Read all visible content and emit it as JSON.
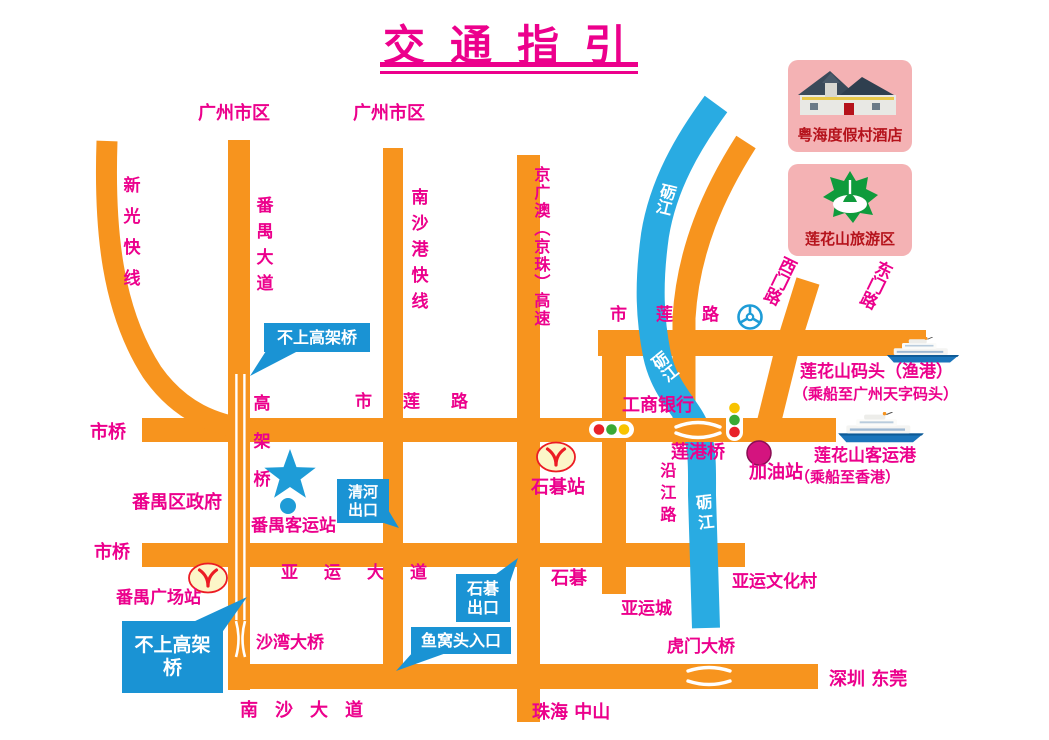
{
  "title": "交通指引",
  "panels": {
    "hotel": {
      "label": "粤海度假村酒店",
      "icon": "resort-hotel-photo"
    },
    "scenic": {
      "label": "莲花山旅游区",
      "icon": "lotus-mountain-emblem"
    }
  },
  "labels": {
    "gz_city_1": "广州市区",
    "gz_city_2": "广州市区",
    "xinguang_expwy": "新光快线",
    "panyu_avenue": "番禺大道",
    "nanshagang_expwy": "南沙港快线",
    "jingzhu_expwy": "京广澳（京珠）高速",
    "shilian_rd_west": "市莲路",
    "shilian_rd_east": "市莲路",
    "ximen_rd": "西门路",
    "dongmen_rd": "东门路",
    "lijiang_river_top": "砺江",
    "lijiang_river_mid": "砺江",
    "lijiang_river_low": "砺江",
    "icbc_bank": "工商银行",
    "liangang_bridge": "莲港桥",
    "yanjiang_rd": "沿江路",
    "gas_station": "加油站",
    "ferry_pier_line1": "莲花山码头（渔港）",
    "ferry_pier_line2": "（乘船至广州天字码头）",
    "passenger_port_line1": "莲花山客运港",
    "passenger_port_line2": "（乘船至香港）",
    "shiqiao_upper": "市桥",
    "shiqiao_lower": "市桥",
    "viaduct": "高架桥",
    "panyu_government": "番禺区政府",
    "panyu_bus_terminal": "番禺客运站",
    "shiqi_metro_station": "石碁站",
    "panyu_square_station": "番禺广场站",
    "yayun_avenue": "亚运大道",
    "shawan_bridge": "沙湾大桥",
    "shiqi": "石碁",
    "yayun_city": "亚运城",
    "yayun_culture_village": "亚运文化村",
    "humen_bridge": "虎门大桥",
    "shenzhen_dongguan": "深圳 东莞",
    "nansha_avenue": "南沙大道",
    "zhuhai_zhongshan": "珠海 中山"
  },
  "callouts": {
    "no_viaduct_top": "不上高架桥",
    "qinghe_exit": "清河出口",
    "shiqi_exit": "石碁出口",
    "yuwotou_entry": "鱼窝头入口",
    "no_viaduct_bottom": "不上高架桥"
  },
  "colors": {
    "road": "#F7941E",
    "river": "#29ABE2",
    "road_label": "#EC008C",
    "callout_bg": "#1A93D4",
    "panel_bg": "#F4B2B4",
    "panel_text": "#B5121B",
    "metro_fill": "#FCF6C8",
    "metro_red": "#EC1C24",
    "star_blue": "#1E9CD7",
    "gas_dot": "#D4147F",
    "traffic_red": "#E8212A",
    "traffic_green": "#39A935",
    "traffic_yellow": "#F8C300"
  }
}
